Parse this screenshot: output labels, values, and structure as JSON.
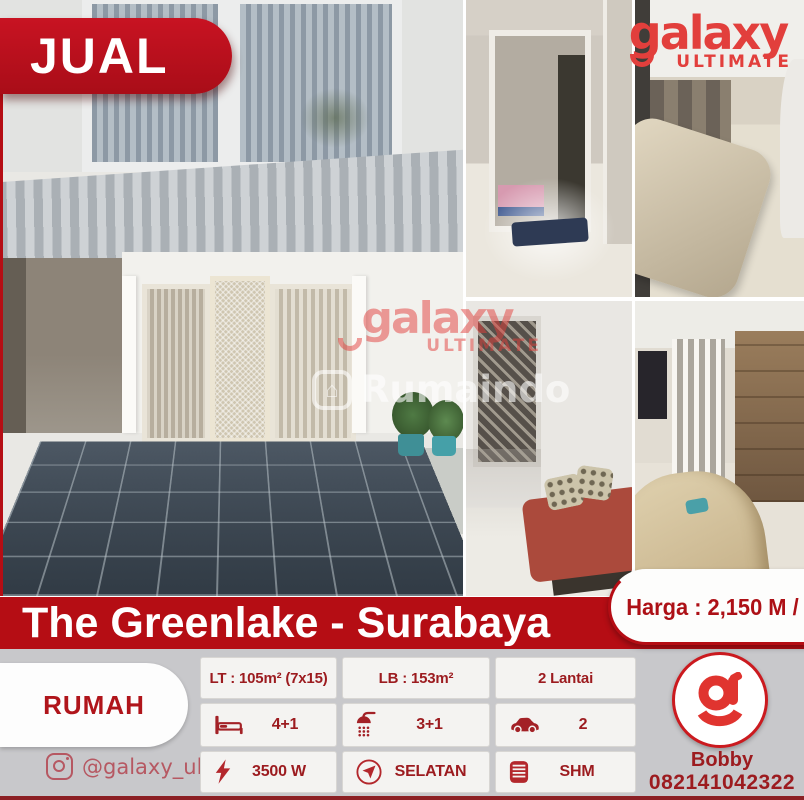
{
  "sale_badge": "JUAL",
  "brand_logo": {
    "word": "galaxy",
    "sub": "ULTIMATE"
  },
  "watermark_portal": "Rumaindo",
  "title_banner": "The Greenlake - Surabaya",
  "price_badge": "Harga : 2,150 M / Nego",
  "property_type": "RUMAH",
  "specs": {
    "land_area": "LT : 105m² (7x15)",
    "building_area": "LB : 153m²",
    "floors": "2 Lantai",
    "bedrooms": "4+1",
    "bathrooms": "3+1",
    "carport": "2",
    "power": "3500 W",
    "facing": "SELATAN",
    "certificate": "SHM"
  },
  "contact": {
    "instagram": "@galaxy_ultimate",
    "agent_name": "Bobby",
    "phone": "082141042322"
  },
  "colors": {
    "brand_red": "#b50d14",
    "logo_red": "#e23f3c",
    "text_maroon": "#9c1b1f",
    "background_gray": "#c8c8cb"
  },
  "icons": [
    "bed-icon",
    "shower-icon",
    "car-icon",
    "lightning-icon",
    "compass-icon",
    "certificate-icon",
    "instagram-icon",
    "galaxy-g-icon",
    "house-icon"
  ]
}
